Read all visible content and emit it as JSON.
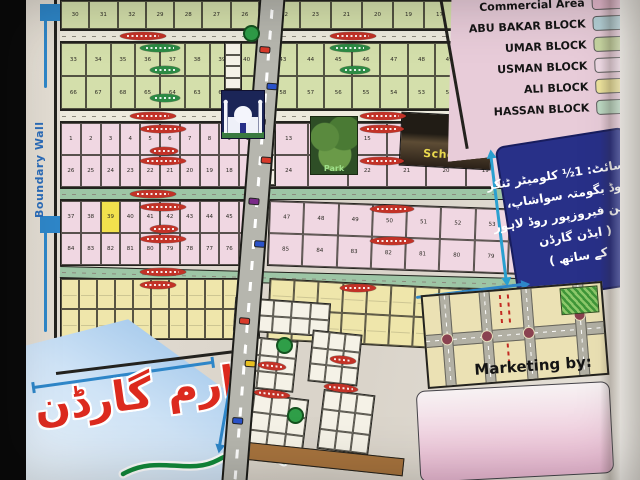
{
  "legend": {
    "items": [
      {
        "label": "Commercial Area",
        "color": "#e4b8cc"
      },
      {
        "label": "ABU BAKAR BLOCK",
        "color": "#b6d2d8"
      },
      {
        "label": "UMAR BLOCK",
        "color": "#c8d6a2"
      },
      {
        "label": "USMAN BLOCK",
        "color": "#eed9e4"
      },
      {
        "label": "ALI BLOCK",
        "color": "#ece29c"
      },
      {
        "label": "HASSAN BLOCK",
        "color": "#bcd8c2"
      }
    ]
  },
  "info_box": {
    "lines": [
      "سائٹ: 1½ کلومیٹر ٹنکر",
      "روڈ بگومتہ سواشاپ،",
      "مین فیروزپور روڈ لاہور",
      "( ایڈن گارڈن",
      "کے ساتھ )"
    ]
  },
  "marketing": {
    "label": "Marketing by:"
  },
  "title": {
    "text": "ارم گارڈن"
  },
  "map": {
    "boundary_wall_label": "Boundary Wall",
    "school_label": "School",
    "park_label": "Park",
    "umar_left": [
      [
        "30",
        "31",
        "32",
        "29",
        "28",
        "27",
        "26"
      ]
    ],
    "umar_left2": [
      [
        "33",
        "34",
        "35",
        "36",
        "37",
        "38",
        "39",
        "40"
      ],
      [
        "66",
        "67",
        "68",
        "65",
        "64",
        "63",
        "62",
        "61"
      ]
    ],
    "umar_right": [
      [
        "22",
        "23",
        "21",
        "20",
        "19",
        "17"
      ]
    ],
    "umar_right2": [
      [
        "43",
        "44",
        "45",
        "46",
        "47",
        "48",
        "49"
      ],
      [
        "58",
        "57",
        "56",
        "55",
        "54",
        "53",
        "52"
      ]
    ],
    "usman_left": [
      [
        "1",
        "2",
        "3",
        "4",
        "5",
        "6",
        "7",
        "8",
        "9",
        "10"
      ],
      [
        "26",
        "25",
        "24",
        "23",
        "22",
        "21",
        "20",
        "19",
        "18",
        "17"
      ]
    ],
    "usman_left2": [
      [
        "37",
        "38",
        "39",
        "40",
        "41",
        "42",
        "43",
        "44",
        "45",
        "46"
      ],
      [
        "84",
        "83",
        "82",
        "81",
        "80",
        "79",
        "78",
        "77",
        "76",
        "75"
      ]
    ],
    "usman_right": [
      [
        "13",
        "14",
        "15",
        "16",
        "17",
        "18"
      ],
      [
        "24",
        "23",
        "22",
        "21",
        "20",
        "19"
      ]
    ],
    "usman_right2": [
      [
        "47",
        "48",
        "49",
        "50",
        "51",
        "52",
        "53",
        "54"
      ],
      [
        "85",
        "84",
        "83",
        "82",
        "81",
        "80",
        "79",
        "78"
      ]
    ],
    "ali_left": [
      [
        "",
        "",
        "",
        "",
        "",
        "",
        "",
        "",
        "",
        "",
        ""
      ],
      [
        "",
        "",
        "",
        "",
        "",
        "",
        "",
        "",
        "",
        "",
        ""
      ]
    ],
    "ali_right": [
      [
        "",
        "",
        "",
        "",
        "",
        "",
        "",
        "",
        "",
        "",
        "",
        ""
      ],
      [
        "",
        "",
        "",
        "",
        "",
        "",
        "",
        "",
        "",
        "",
        "",
        ""
      ]
    ],
    "mix_patch": [
      [
        "",
        "",
        "",
        "",
        ""
      ],
      [
        "",
        "",
        "",
        "",
        ""
      ]
    ],
    "hassan_p1": [
      [
        "",
        "",
        ""
      ],
      [
        "",
        "",
        ""
      ],
      [
        "",
        "",
        ""
      ]
    ],
    "hassan_p2": [
      [
        "",
        "",
        ""
      ],
      [
        "",
        "",
        ""
      ],
      [
        "",
        "",
        ""
      ]
    ],
    "hassan_p3": [
      [
        "",
        "",
        ""
      ],
      [
        "",
        "",
        ""
      ],
      [
        "",
        "",
        ""
      ]
    ],
    "hassan_p4": [
      [
        "",
        "",
        ""
      ],
      [
        "",
        "",
        ""
      ],
      [
        "",
        "",
        ""
      ]
    ],
    "commercial_strip_a": [
      [
        ""
      ],
      [
        ""
      ],
      [
        ""
      ],
      [
        ""
      ]
    ],
    "commercial_strip_b": [
      [
        ""
      ],
      [
        ""
      ],
      [
        ""
      ],
      [
        ""
      ]
    ]
  }
}
